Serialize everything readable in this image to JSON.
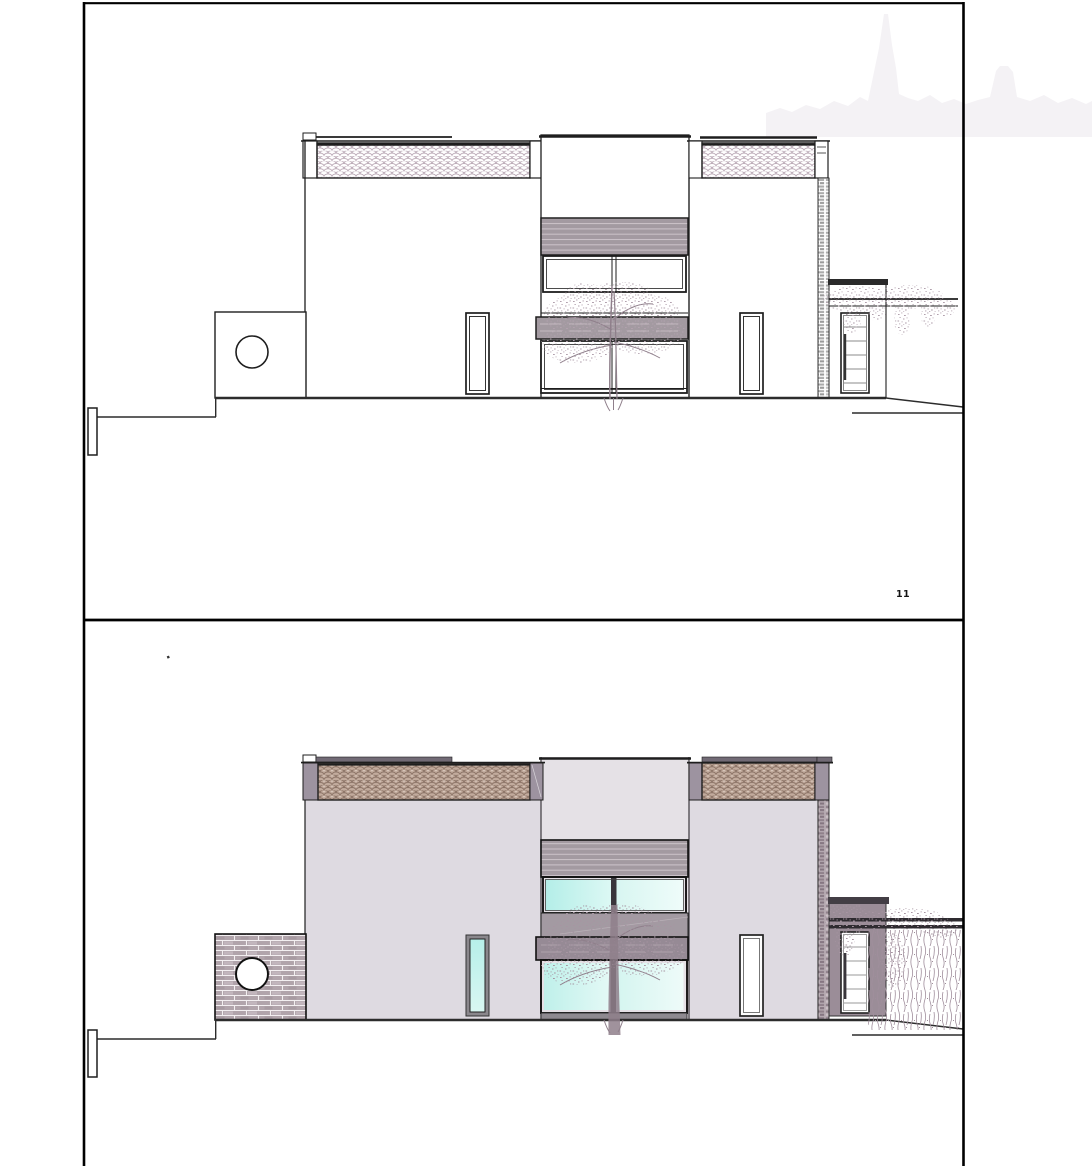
{
  "document": {
    "sheet_label": "11"
  },
  "colors": {
    "paper": "#ffffff",
    "line": "#1e1e1e",
    "ground": "#2c2c2c",
    "wall": "#dedae1",
    "tower_wall": "#e5e1e6",
    "cap": "#9d93a0",
    "coping": "#716a75",
    "tile_bg": "#c2ab9d",
    "tile_stroke_bottom": "#8a7265",
    "tile_stroke_top": "#b5a2b0",
    "louver": "#a39aa1",
    "louver_line": "#cdc4ca",
    "spandrel": "#a39aa2",
    "slab": "#968a95",
    "porch": "#9b8d98",
    "canopy": "#433e45",
    "brick": "#b1a4ab",
    "brick_mortar": "#f3eff1",
    "brick_light": "#c6bac1",
    "pillar_dark": "#90818b",
    "pillar_light": "#cbc0c6",
    "pillar_mid": "#857681",
    "glass_strong": "#b4eee8",
    "glass_mid": "#d8f6f1",
    "glass_soft": "#effcfa",
    "frame_gray": "#8a878c",
    "frame_dark": "#39353b",
    "sill": "#8e8a90",
    "foliage_top": "#b2a1ae",
    "foliage_bottom": "#a794a2",
    "vine": "#a08e9c",
    "trunk": "#8f7f8b",
    "skyline": "#f4f2f5",
    "door_line": "#9a9a9a"
  }
}
